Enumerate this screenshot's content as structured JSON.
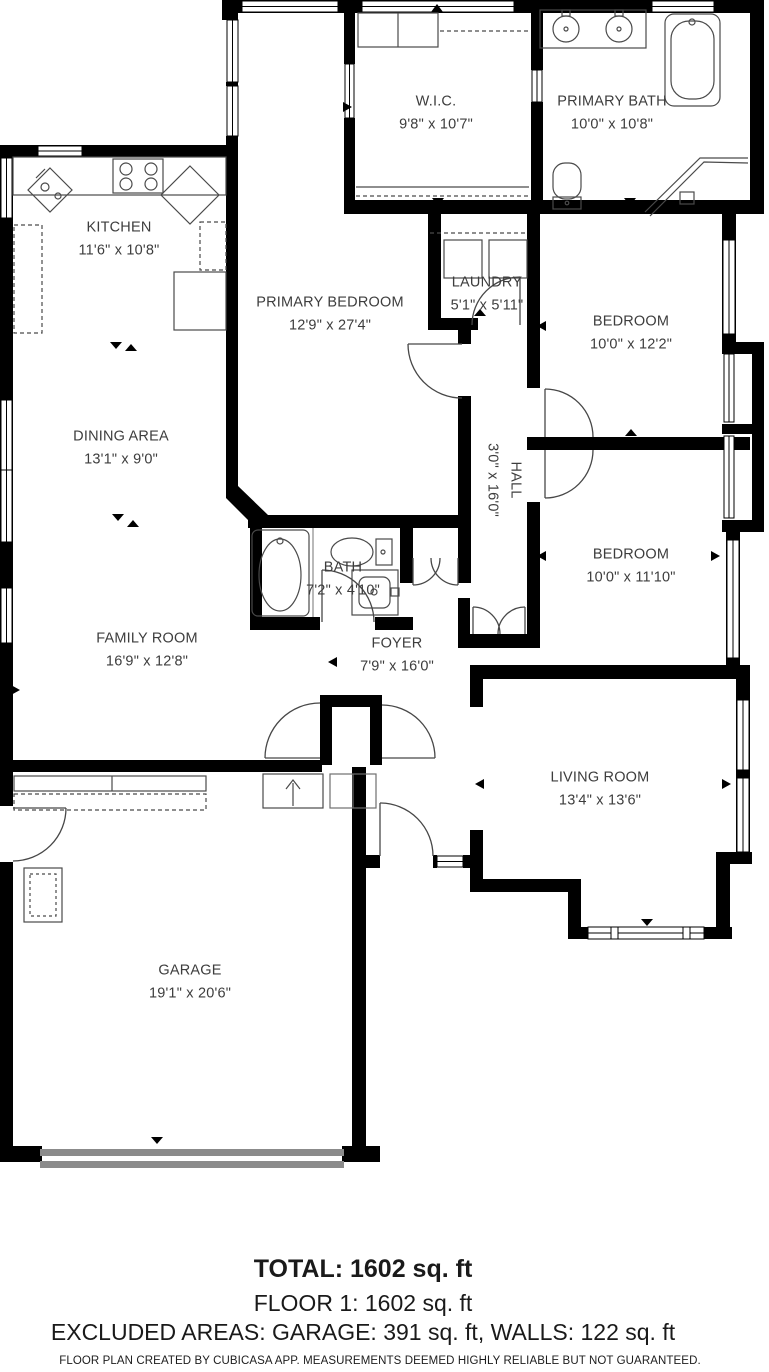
{
  "plan": {
    "rooms": {
      "wic": {
        "name": "W.I.C.",
        "dims": "9'8\" x 10'7\""
      },
      "primary_bath": {
        "name": "PRIMARY BATH",
        "dims": "10'0\" x 10'8\""
      },
      "kitchen": {
        "name": "KITCHEN",
        "dims": "11'6\" x 10'8\""
      },
      "primary_bedroom": {
        "name": "PRIMARY BEDROOM",
        "dims": "12'9\" x 27'4\""
      },
      "laundry": {
        "name": "LAUNDRY",
        "dims": "5'1\" x 5'11\""
      },
      "bedroom_top": {
        "name": "BEDROOM",
        "dims": "10'0\" x 12'2\""
      },
      "dining": {
        "name": "DINING AREA",
        "dims": "13'1\" x 9'0\""
      },
      "hall": {
        "name": "HALL",
        "dims": "3'0\" x 16'0\""
      },
      "bedroom_mid": {
        "name": "BEDROOM",
        "dims": "10'0\" x 11'10\""
      },
      "bath": {
        "name": "BATH",
        "dims": "7'2\" x 4'10\""
      },
      "family": {
        "name": "FAMILY ROOM",
        "dims": "16'9\" x 12'8\""
      },
      "foyer": {
        "name": "FOYER",
        "dims": "7'9\" x 16'0\""
      },
      "living": {
        "name": "LIVING ROOM",
        "dims": "13'4\" x 13'6\""
      },
      "garage": {
        "name": "GARAGE",
        "dims": "19'1\" x 20'6\""
      }
    }
  },
  "summary": {
    "total": "TOTAL: 1602 sq. ft",
    "floor": "FLOOR 1: 1602 sq. ft",
    "excluded": "EXCLUDED AREAS: GARAGE: 391 sq. ft, WALLS: 122 sq. ft"
  },
  "disclaimer": "FLOOR PLAN CREATED BY CUBICASA APP. MEASUREMENTS DEEMED HIGHLY RELIABLE BUT NOT GUARANTEED.",
  "colors": {
    "wall": "#000000",
    "floor": "#ffffff",
    "fixture": "#4a4a4a",
    "garage_door": "#8b8b8b",
    "label_text": "#3d3d3d",
    "summary_text": "#1a1a1a"
  }
}
